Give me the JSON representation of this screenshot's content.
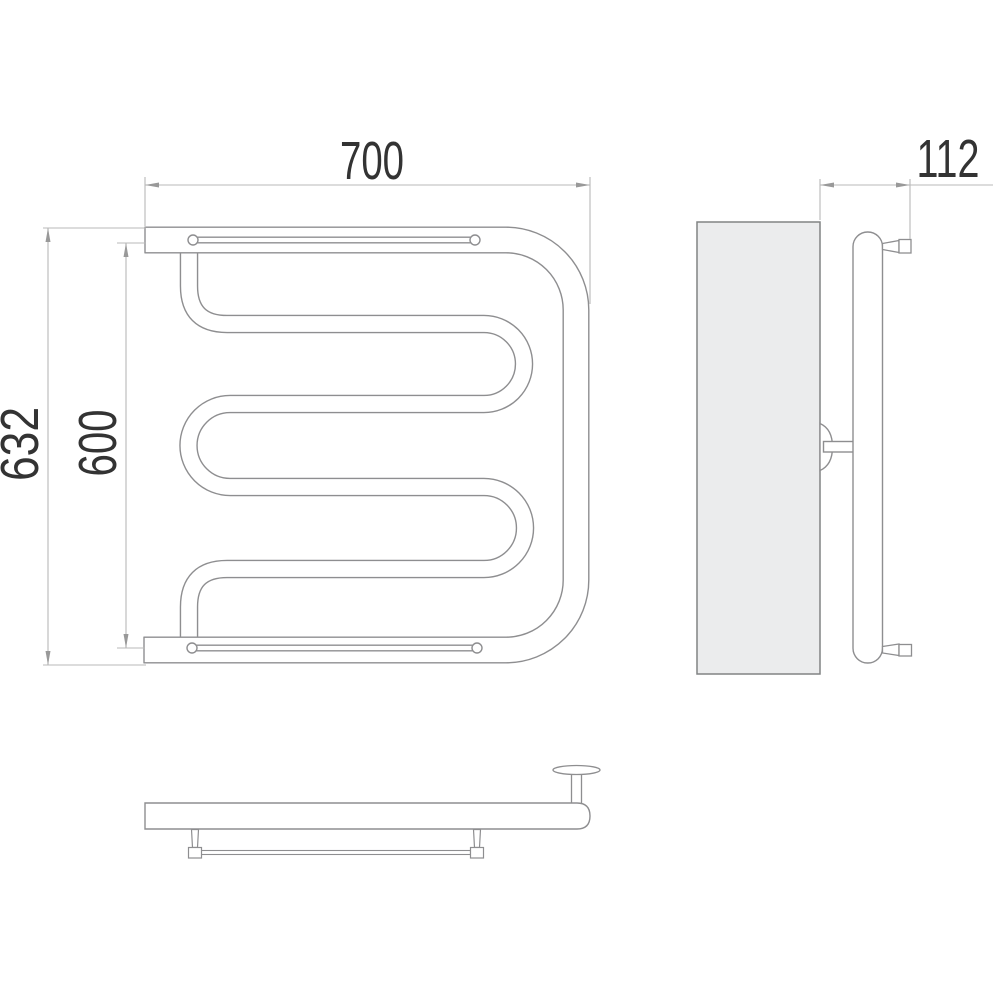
{
  "drawing": {
    "type": "technical-dimension-drawing",
    "subject": "wall-mounted towel warmer, three orthographic views",
    "dimensions": {
      "width": "700",
      "depth": "112",
      "overall_height": "632",
      "axis_height": "600"
    },
    "colors": {
      "background": "#ffffff",
      "object_line": "#8e8e90",
      "dimension_line": "#b9b9b9",
      "arrow": "#999999",
      "text": "#333333",
      "wall_fill": "#ebeced",
      "wall_stroke": "#818384"
    }
  }
}
